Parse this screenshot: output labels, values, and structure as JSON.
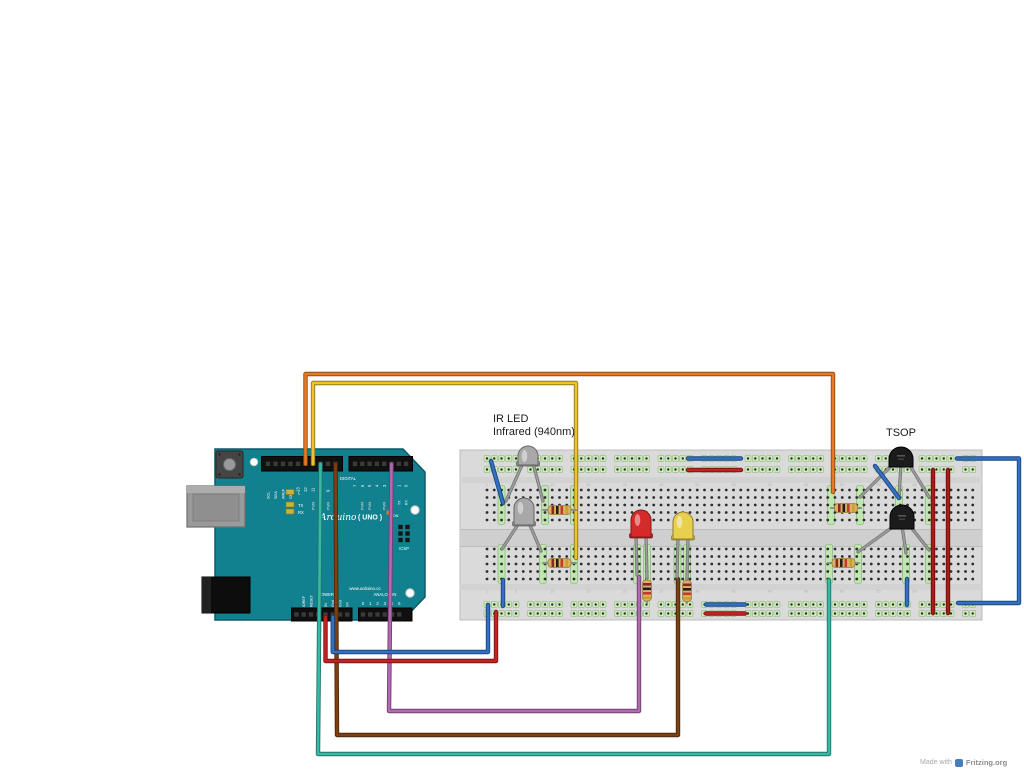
{
  "texts": {
    "ir_led_label_line1": "IR LED",
    "ir_led_label_line2": "Infrared (940nm)",
    "tsop_label": "TSOP",
    "watermark": "Made with",
    "watermark_brand": "Fritzing.org"
  },
  "colors": {
    "board_teal": "#12818f",
    "board_teal_dark": "#0a5a66",
    "breadboard_body": "#dadada",
    "breadboard_channel": "#cfcfcf",
    "rail_cell_fill": "#cdeab8",
    "rail_cell_stroke": "#7fae72",
    "highlight_fill": "#bfe6ac",
    "highlight_stroke": "#79b06c",
    "hole_dot": "#2f2f2f",
    "wire_orange": "#e87a24",
    "wire_yellow": "#ecc32f",
    "wire_teal": "#37b9a6",
    "wire_brown": "#7c4012",
    "wire_purple": "#b268b2",
    "wire_red": "#c42323",
    "wire_dark_red": "#a81c15",
    "wire_blue": "#3071c5",
    "led_red": "#d42a2a",
    "led_yellow": "#e8cf4e",
    "led_gray": "#a8a8a8",
    "tsop_black": "#1b1b1b",
    "resistor_tan": "#d9b26a",
    "resistor_bands": [
      "#8a2b1a",
      "#1f1f1f",
      "#c23b2a",
      "#c9a227"
    ],
    "led_indicator": "#c9b43a",
    "on_led": "#e87722",
    "leg_gray": "#9c9c9c"
  },
  "arduino": {
    "digital_left_pins": [
      "SCL",
      "SDA",
      "AREF",
      "GND",
      "13",
      "12",
      "11",
      "10",
      "9",
      "8"
    ],
    "digital_right_pins": [
      "7",
      "6",
      "5",
      "4",
      "3",
      "2",
      "1",
      "0"
    ],
    "digital_label": "DIGITAL",
    "pwm_label": "PWM",
    "tx_label": "TX",
    "rx_label": "RX",
    "led_labels": [
      "L",
      "TX",
      "RX"
    ],
    "brand": "Arduino",
    "model": "( UNO )",
    "on_label": "ON",
    "icsp_label": "ICSP",
    "url": "www.arduino.cc",
    "power_label": "POWER",
    "analog_label": "ANALOG IN",
    "power_pins": [
      "IOREF",
      "RESET",
      "3.3V",
      "5V",
      "Gnd",
      "Gnd",
      "Vin"
    ],
    "analog_pins": [
      "0",
      "1",
      "2",
      "3",
      "4",
      "5"
    ]
  },
  "breadboard": {
    "x": 460,
    "y": 450,
    "w": 522,
    "h": 170,
    "col0": 487,
    "pitch": 7.25,
    "cols": 68,
    "rail_rows_top": [
      458.5,
      469.5
    ],
    "rail_rows_bottom": [
      604.5,
      613.5
    ],
    "rows_top": [
      490,
      497.5,
      505,
      512.5,
      520
    ],
    "rows_bottom": [
      549,
      556.5,
      564,
      571.5,
      579
    ],
    "channel_y": 529,
    "channel_h": 18,
    "highlights_top": [
      501.5,
      545,
      574,
      831,
      860,
      899,
      929
    ],
    "highlights_bottom": [
      501.5,
      543,
      574,
      637,
      647,
      677.5,
      687,
      829,
      858,
      906,
      929
    ],
    "col_numbers": [
      1,
      5,
      10,
      15,
      20,
      25,
      30,
      35,
      40,
      45,
      50,
      55,
      60
    ]
  },
  "wires": [
    {
      "name": "wire-orange-pin12-to-tsop-row",
      "color": "wire_orange",
      "points": [
        [
          305.5,
          464
        ],
        [
          305.5,
          374
        ],
        [
          833,
          374
        ],
        [
          833,
          492
        ]
      ],
      "layer": "base"
    },
    {
      "name": "wire-yellow-pin11-to-ir-led-row",
      "color": "wire_yellow",
      "points": [
        [
          313,
          464
        ],
        [
          313,
          383
        ],
        [
          576,
          383
        ],
        [
          576,
          558
        ]
      ],
      "layer": "base"
    },
    {
      "name": "wire-teal-pin10-to-tsop2-row",
      "color": "wire_teal",
      "points": [
        [
          320.5,
          464
        ],
        [
          318,
          754
        ],
        [
          829,
          754
        ],
        [
          829,
          580
        ]
      ],
      "layer": "base"
    },
    {
      "name": "wire-brown-pin8-to-yellow-led-row",
      "color": "wire_brown",
      "points": [
        [
          335.5,
          464
        ],
        [
          337,
          735
        ],
        [
          678,
          735
        ],
        [
          678,
          579
        ]
      ],
      "layer": "base"
    },
    {
      "name": "wire-purple-pin2-to-red-led-row",
      "color": "wire_purple",
      "points": [
        [
          391.5,
          464
        ],
        [
          389,
          711
        ],
        [
          639,
          711
        ],
        [
          639,
          577
        ]
      ],
      "layer": "base"
    },
    {
      "name": "wire-red-5v-to-bottom-rail",
      "color": "wire_red",
      "points": [
        [
          325.5,
          617
        ],
        [
          325.5,
          661
        ],
        [
          496,
          661
        ],
        [
          496,
          612
        ]
      ],
      "layer": "base"
    },
    {
      "name": "wire-blue-gnd-to-bottom-rail",
      "color": "wire_blue",
      "points": [
        [
          332.75,
          617
        ],
        [
          332.75,
          652
        ],
        [
          488,
          652
        ],
        [
          488,
          605
        ]
      ],
      "layer": "base"
    },
    {
      "name": "wire-blue-rail-loop-right",
      "color": "wire_blue",
      "points": [
        [
          957,
          458.5
        ],
        [
          1019,
          458.5
        ],
        [
          1019,
          603
        ],
        [
          958,
          603
        ]
      ],
      "layer": "base"
    },
    {
      "name": "wire-red-rail-link-1",
      "color": "wire_dark_red",
      "points": [
        [
          933,
          470
        ],
        [
          933,
          613
        ]
      ],
      "layer": "base"
    },
    {
      "name": "wire-red-rail-link-2",
      "color": "wire_dark_red",
      "points": [
        [
          948,
          470
        ],
        [
          948,
          613
        ]
      ],
      "layer": "base"
    },
    {
      "name": "wire-blue-bridge-top-rail",
      "color": "wire_blue",
      "points": [
        [
          688,
          458.5
        ],
        [
          741,
          458.5
        ]
      ],
      "layer": "base"
    },
    {
      "name": "wire-red-bridge-top-rail",
      "color": "wire_red",
      "points": [
        [
          688,
          470
        ],
        [
          741,
          470
        ]
      ],
      "layer": "base"
    },
    {
      "name": "wire-blue-bridge-bottom-rail",
      "color": "wire_blue",
      "points": [
        [
          706,
          604.5
        ],
        [
          745,
          604.5
        ]
      ],
      "layer": "base"
    },
    {
      "name": "wire-red-bridge-bottom-rail",
      "color": "wire_red",
      "points": [
        [
          706,
          613.5
        ],
        [
          745,
          613.5
        ]
      ],
      "layer": "base"
    },
    {
      "name": "wire-blue-jumper-ir-led2-gnd",
      "color": "wire_blue",
      "points": [
        [
          503,
          580
        ],
        [
          503,
          606
        ]
      ],
      "layer": "base"
    },
    {
      "name": "wire-blue-jumper-tsop2-gnd",
      "color": "wire_blue",
      "points": [
        [
          907,
          579
        ],
        [
          907,
          605
        ]
      ],
      "layer": "base"
    },
    {
      "name": "wire-blue-diag-ir-led1-gnd",
      "color": "wire_blue",
      "points": [
        [
          491,
          461
        ],
        [
          503,
          503
        ]
      ],
      "layer": "top"
    },
    {
      "name": "wire-blue-diag-tsop1-gnd",
      "color": "wire_blue",
      "points": [
        [
          875,
          466
        ],
        [
          899,
          498
        ]
      ],
      "layer": "top"
    }
  ],
  "components": {
    "ir_leds": [
      {
        "name": "ir-led-1",
        "cx": 528,
        "top": 446,
        "bottom": 466,
        "legs": [
          [
            506,
            501
          ],
          [
            543,
            501
          ]
        ]
      },
      {
        "name": "ir-led-2",
        "cx": 524,
        "top": 498,
        "bottom": 526,
        "legs": [
          [
            502,
            549
          ],
          [
            541,
            551
          ]
        ]
      }
    ],
    "leds": [
      {
        "name": "led-red",
        "color": "led_red",
        "cx": 641,
        "top": 510,
        "bottom": 538,
        "legs": [
          [
            637,
            575
          ],
          [
            647,
            578
          ]
        ]
      },
      {
        "name": "led-yellow",
        "color": "led_yellow",
        "cx": 683,
        "top": 512,
        "bottom": 540,
        "legs": [
          [
            677,
            577
          ],
          [
            687,
            579
          ]
        ]
      }
    ],
    "resistors_h": [
      {
        "name": "resistor-ir-led1",
        "x1": 543,
        "x2": 576,
        "y": 510
      },
      {
        "name": "resistor-ir-led2",
        "x1": 543,
        "x2": 576,
        "y": 563
      },
      {
        "name": "resistor-tsop1",
        "x1": 831,
        "x2": 861,
        "y": 508
      },
      {
        "name": "resistor-tsop2",
        "x1": 828,
        "x2": 859,
        "y": 563
      }
    ],
    "resistors_v": [
      {
        "name": "resistor-led-red",
        "x": 647,
        "y1": 578,
        "y2": 603
      },
      {
        "name": "resistor-led-yellow",
        "x": 687,
        "y1": 579,
        "y2": 603
      }
    ],
    "tsops": [
      {
        "name": "tsop-receiver-1",
        "cx": 901,
        "top": 447,
        "bottom": 467,
        "legs": [
          [
            860,
            497
          ],
          [
            899,
            497
          ],
          [
            929,
            497
          ]
        ]
      },
      {
        "name": "tsop-receiver-2",
        "cx": 902,
        "top": 505,
        "bottom": 529,
        "legs": [
          [
            858,
            552
          ],
          [
            906,
            553
          ],
          [
            929,
            550
          ]
        ]
      }
    ]
  }
}
